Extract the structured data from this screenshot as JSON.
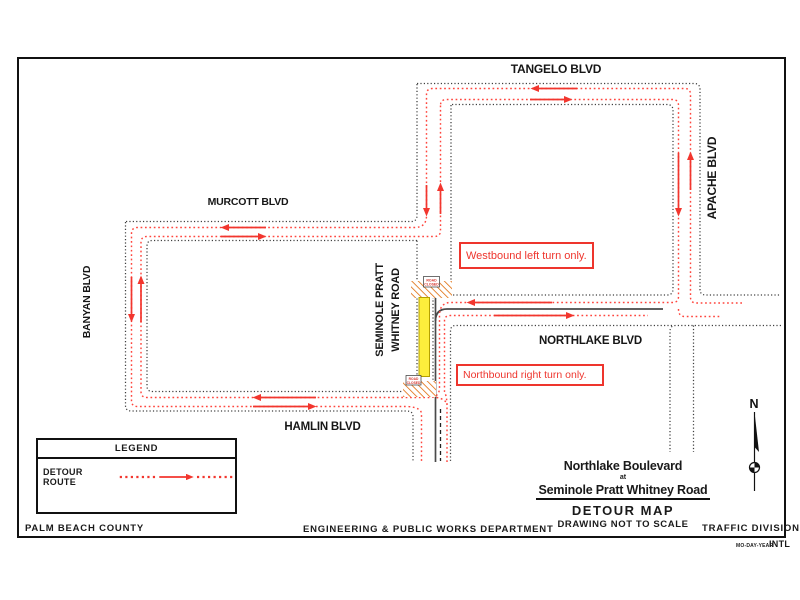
{
  "map": {
    "road_labels": {
      "tangelo": "TANGELO BLVD",
      "apache": "APACHE BLVD",
      "murcott": "MURCOTT BLVD",
      "banyan": "BANYAN BLVD",
      "seminole_line1": "SEMINOLE  PRATT",
      "seminole_line2": "WHITNEY ROAD",
      "northlake": "NORTHLAKE BLVD",
      "hamlin": "HAMLIN BLVD"
    },
    "callouts": {
      "westbound": "Westbound left turn only.",
      "northbound": "Northbound right turn only."
    },
    "road_closed_sign": {
      "line1": "ROAD",
      "line2": "CLOSED"
    },
    "compass_north": "N"
  },
  "legend": {
    "title": "LEGEND",
    "detour_route_label": "DETOUR ROUTE"
  },
  "title_block": {
    "line1": "Northlake Boulevard",
    "line2": "at",
    "line3": "Seminole Pratt Whitney Road",
    "line4": "DETOUR MAP",
    "line5": "DRAWING NOT TO SCALE"
  },
  "footer": {
    "left": "PALM BEACH COUNTY",
    "center": "ENGINEERING & PUBLIC WORKS DEPARTMENT",
    "right": "TRAFFIC DIVISION",
    "date_format": "MO-DAY-YEAR",
    "initials": "INTL"
  },
  "colors": {
    "detour_red": "#ff453d",
    "arrow_red": "#f2362e",
    "road_gray": "#3f3f3f",
    "closure_yellow": "#fdee3c",
    "hatch_orange": "#e2791f"
  }
}
